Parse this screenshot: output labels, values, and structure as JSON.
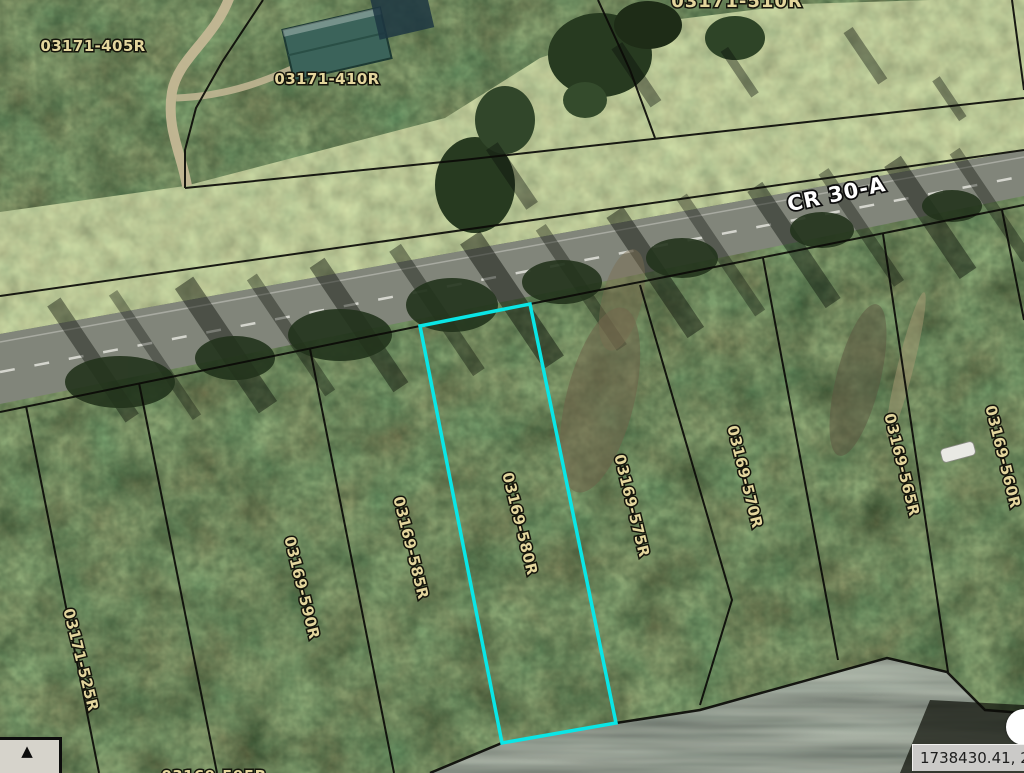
{
  "map": {
    "road_label": "CR 30-A",
    "road_label_color": "#ffffff",
    "parcel_label_color": "#e4d69d",
    "highlighted_parcel": "03169-580R",
    "highlight_color": "#0ae6e6",
    "parcel_labels": [
      {
        "text": "03171-405R",
        "partial": false
      },
      {
        "text": "03171-410R",
        "partial": false
      },
      {
        "text": "03171-510R",
        "partial": true
      },
      {
        "text": "03171-525R",
        "partial": false
      },
      {
        "text": "03169-590R",
        "partial": false
      },
      {
        "text": "03169-585R",
        "partial": false
      },
      {
        "text": "03169-580R",
        "partial": false
      },
      {
        "text": "03169-575R",
        "partial": false
      },
      {
        "text": "03169-570R",
        "partial": false
      },
      {
        "text": "03169-565R",
        "partial": false
      },
      {
        "text": "03169-560R",
        "partial": false
      },
      {
        "text": "03169-595R",
        "partial": true
      }
    ]
  },
  "statusbar": {
    "coordinate_readout": "1738430.41, 25"
  },
  "controls": {
    "overview_toggle_icon": "triangle-up",
    "overview_toggle_glyph": "▲"
  }
}
